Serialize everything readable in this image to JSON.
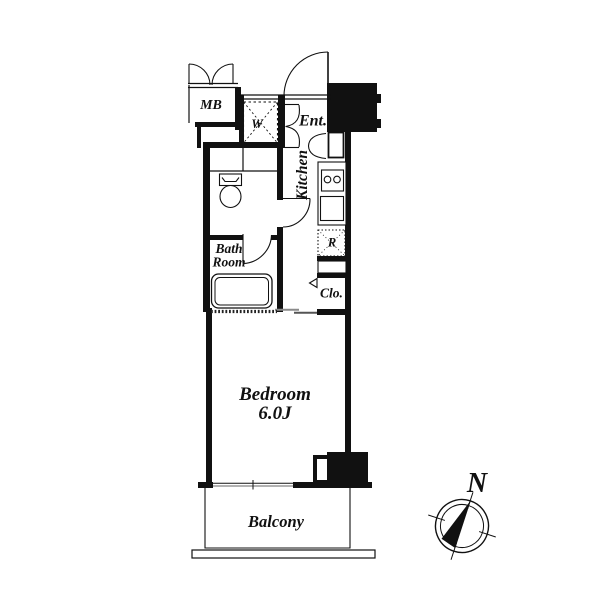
{
  "floorplan": {
    "labels": {
      "meter_box": "MB",
      "washer": "W",
      "entrance": "Ent.",
      "kitchen": "Kitchen",
      "bath_line1": "Bath",
      "bath_line2": "Room",
      "refrigerator": "R",
      "closet": "Clo.",
      "bedroom_name": "Bedroom",
      "bedroom_size": "6.0J",
      "balcony": "Balcony"
    },
    "compass": {
      "north": "N"
    },
    "colors": {
      "line": "#111111",
      "window_glass": "#999999",
      "slider_dark": "#555555",
      "background": "#ffffff"
    }
  }
}
